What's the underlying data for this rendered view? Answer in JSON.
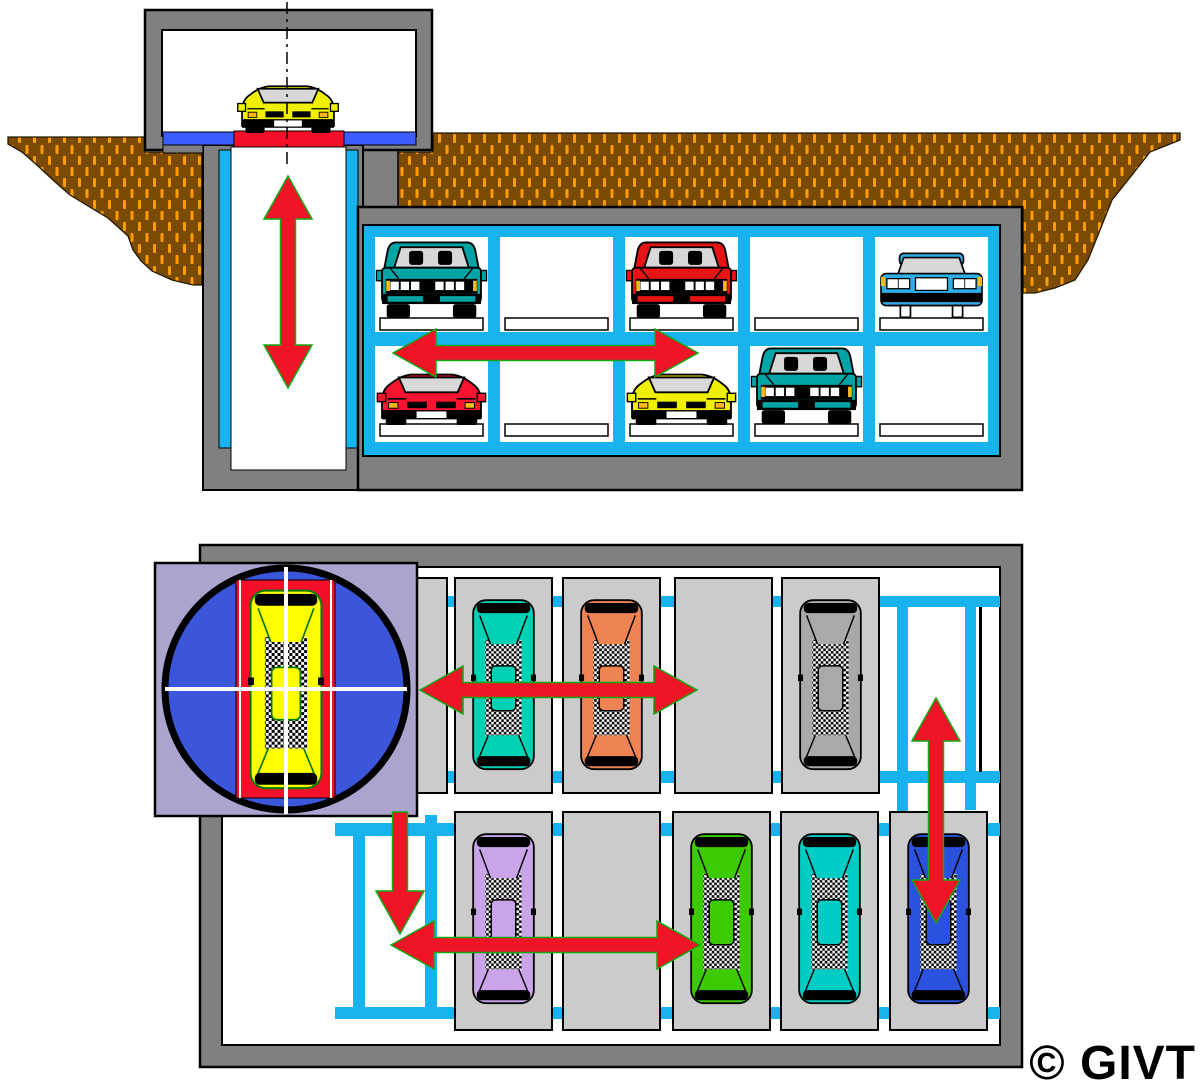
{
  "copyright": {
    "text": "© GIVT"
  },
  "palette": {
    "page_bg": "#FFFFFF",
    "wall_gray": "#808080",
    "stall_gray": "#CBCBCB",
    "rail_cyan": "#18B2EF",
    "arrow_red": "#EF1527",
    "arrow_tip_green": "#12A812",
    "earth_brown": "#7B4B04",
    "earth_hatch_orange": "#FF9C00",
    "floor_blue": "#3D5CFF",
    "platform_red": "#F50F28",
    "turntable_blue": "#3B55DB",
    "inset_lavender": "#ACA4CF",
    "glass_gray": "#D8D8D8",
    "pallet_white": "#FFFFFF"
  },
  "cross_section": {
    "name": "underground-garage-cross-section",
    "earth_polygons": {
      "surface_left": [
        [
          8,
          137
        ],
        [
          145,
          137
        ],
        [
          145,
          152
        ],
        [
          202,
          152
        ],
        [
          202,
          285
        ],
        [
          193,
          285
        ],
        [
          172,
          280
        ],
        [
          152,
          271
        ],
        [
          141,
          261
        ],
        [
          133,
          250
        ],
        [
          128,
          236
        ],
        [
          118,
          227
        ],
        [
          108,
          218
        ],
        [
          88,
          206
        ],
        [
          70,
          195
        ],
        [
          54,
          181
        ],
        [
          38,
          166
        ],
        [
          22,
          152
        ],
        [
          8,
          144
        ]
      ],
      "surface_right": [
        [
          396,
          207
        ],
        [
          396,
          152
        ],
        [
          433,
          152
        ],
        [
          433,
          133
        ],
        [
          1180,
          133
        ],
        [
          1180,
          140
        ],
        [
          1150,
          152
        ],
        [
          1132,
          175
        ],
        [
          1112,
          200
        ],
        [
          1100,
          230
        ],
        [
          1088,
          260
        ],
        [
          1075,
          280
        ],
        [
          1055,
          288
        ],
        [
          1035,
          293
        ],
        [
          1023,
          293
        ],
        [
          1023,
          207
        ]
      ]
    },
    "structures": [
      {
        "name": "shaft-top-connector",
        "x": 357,
        "y": 147,
        "w": 41,
        "h": 78,
        "fill": "wall_gray",
        "stroke": "#000",
        "sw": 1.5
      },
      {
        "name": "entrance-housing",
        "x": 145,
        "y": 10,
        "w": 287,
        "h": 140,
        "fill": "wall_gray",
        "stroke": "#000",
        "sw": 2.5
      },
      {
        "name": "entrance-interior",
        "x": 162,
        "y": 30,
        "w": 254,
        "h": 106,
        "fill": "#FFFFFF",
        "stroke": "#000",
        "sw": 2
      },
      {
        "name": "elevator-shaft-wall",
        "x": 203,
        "y": 145,
        "w": 160,
        "h": 345,
        "fill": "wall_gray",
        "stroke": "#000",
        "sw": 2
      },
      {
        "name": "elevator-shaft",
        "x": 231,
        "y": 147,
        "w": 115,
        "h": 323,
        "fill": "#FFFFFF",
        "stroke": "#000",
        "sw": 1
      },
      {
        "name": "shaft-rail-left",
        "x": 219,
        "y": 150,
        "w": 12,
        "h": 298,
        "fill": "rail_cyan",
        "stroke": "#000",
        "sw": 1
      },
      {
        "name": "shaft-rail-right",
        "x": 346,
        "y": 150,
        "w": 12,
        "h": 298,
        "fill": "rail_cyan",
        "stroke": "#000",
        "sw": 1
      },
      {
        "name": "garage-shell",
        "x": 358,
        "y": 207,
        "w": 664,
        "h": 283,
        "fill": "wall_gray",
        "stroke": "#000",
        "sw": 2.5
      },
      {
        "name": "garage-rack-frame",
        "x": 363,
        "y": 225,
        "w": 637,
        "h": 231,
        "fill": "rail_cyan",
        "stroke": "#000",
        "sw": 2
      },
      {
        "name": "entrance-step-left",
        "x": 163,
        "y": 144,
        "w": 40,
        "h": 9,
        "fill": "wall_gray",
        "stroke": "#000",
        "sw": 1
      },
      {
        "name": "entrance-floor-left",
        "x": 163,
        "y": 132,
        "w": 71,
        "h": 13,
        "fill": "floor_blue",
        "stroke": "#000",
        "sw": 1
      },
      {
        "name": "entrance-floor-right",
        "x": 344,
        "y": 132,
        "w": 72,
        "h": 13,
        "fill": "floor_blue",
        "stroke": "#000",
        "sw": 1
      },
      {
        "name": "elevator-platform",
        "x": 234,
        "y": 131,
        "w": 110,
        "h": 16,
        "fill": "platform_red",
        "stroke": "#000",
        "sw": 1
      }
    ],
    "rack": {
      "cols_x": [
        375,
        500,
        625,
        750,
        875
      ],
      "bay_w": 113,
      "rows": [
        {
          "y": 237,
          "h": 95,
          "pallet_y": 318
        },
        {
          "y": 346,
          "h": 96,
          "pallet_y": 424
        }
      ]
    },
    "center_line": {
      "x": 287,
      "y1": 2,
      "y2": 164
    },
    "cars": [
      {
        "name": "car-yellow-sports-entrance",
        "type": "sports_front",
        "color": "#EFEF00",
        "cx": 288,
        "bottom": 133,
        "w": 104
      },
      {
        "name": "car-teal-sedan-upper-1",
        "type": "sedan_front",
        "color": "#00A4A4",
        "bay": 0,
        "row": 0
      },
      {
        "name": "car-red-sedan-upper-3",
        "type": "sedan_front",
        "color": "#E61414",
        "bay": 2,
        "row": 0
      },
      {
        "name": "car-blue-wide-upper-5",
        "type": "wide_front",
        "color": "#2FADE8",
        "bay": 4,
        "row": 0
      },
      {
        "name": "car-red-sports-lower-1",
        "type": "sports_front",
        "color": "#FA1430",
        "bay": 0,
        "row": 1
      },
      {
        "name": "car-yellow-sports-lower-3",
        "type": "sports_front",
        "color": "#EFEF00",
        "bay": 2,
        "row": 1
      },
      {
        "name": "car-teal-sedan-lower-4",
        "type": "sedan_front",
        "color": "#00A4A4",
        "bay": 3,
        "row": 1
      }
    ],
    "arrows": [
      {
        "name": "elevator-vertical-arrow",
        "dir": "v",
        "x": 288,
        "y1": 176,
        "y2": 388,
        "heads": "both"
      },
      {
        "name": "shuttle-horizontal-arrow",
        "dir": "h",
        "y": 353,
        "x1": 393,
        "x2": 698,
        "heads": "both"
      }
    ]
  },
  "plan_view": {
    "name": "garage-plan-view",
    "structures": [
      {
        "name": "plan-outer-wall",
        "x": 200,
        "y": 545,
        "w": 822,
        "h": 522,
        "fill": "wall_gray",
        "stroke": "#000",
        "sw": 2.5
      },
      {
        "name": "plan-floor",
        "x": 222,
        "y": 567,
        "w": 778,
        "h": 478,
        "fill": "#FFFFFF",
        "stroke": "#000",
        "sw": 2
      }
    ],
    "guide_lines": [
      {
        "name": "guide-h-top",
        "x": 440,
        "y": 596,
        "w": 560,
        "h": 11
      },
      {
        "name": "guide-h-mid-upper",
        "x": 440,
        "y": 771,
        "w": 560,
        "h": 12
      },
      {
        "name": "guide-h-mid-lower",
        "x": 335,
        "y": 823,
        "w": 665,
        "h": 13
      },
      {
        "name": "guide-h-bottom",
        "x": 335,
        "y": 1007,
        "w": 665,
        "h": 12
      },
      {
        "name": "guide-v-lift-left",
        "x": 897,
        "y": 596,
        "w": 11,
        "h": 422
      },
      {
        "name": "guide-v-lift-right",
        "x": 965,
        "y": 596,
        "w": 11,
        "h": 214
      },
      {
        "name": "guide-v-shuttle-left",
        "x": 353,
        "y": 823,
        "w": 12,
        "h": 196
      },
      {
        "name": "guide-v-shuttle-right",
        "x": 425,
        "y": 815,
        "w": 12,
        "h": 204
      }
    ],
    "rail_marks": [
      {
        "name": "lift-rail-mark",
        "x": 979,
        "y": 607,
        "w": 3,
        "h": 165,
        "fill": "#000"
      }
    ],
    "stall_w": 97,
    "stall_h": [
      215,
      218
    ],
    "stalls": [
      {
        "name": "stall-u0",
        "x": 350,
        "y": 578,
        "row": 0
      },
      {
        "name": "stall-u1",
        "x": 455,
        "y": 578,
        "row": 0
      },
      {
        "name": "stall-u2",
        "x": 563,
        "y": 578,
        "row": 0
      },
      {
        "name": "stall-u3-empty",
        "x": 675,
        "y": 578,
        "row": 0
      },
      {
        "name": "stall-u4",
        "x": 782,
        "y": 578,
        "row": 0
      },
      {
        "name": "stall-l1",
        "x": 455,
        "y": 812,
        "row": 1
      },
      {
        "name": "stall-l2-empty",
        "x": 563,
        "y": 812,
        "row": 1
      },
      {
        "name": "stall-l3",
        "x": 673,
        "y": 812,
        "row": 1
      },
      {
        "name": "stall-l4",
        "x": 781,
        "y": 812,
        "row": 1
      },
      {
        "name": "stall-l5",
        "x": 890,
        "y": 812,
        "row": 1
      }
    ],
    "cars": [
      {
        "name": "plan-car-teal",
        "stall": 1,
        "color": "#00D0B4"
      },
      {
        "name": "plan-car-orange",
        "stall": 2,
        "color": "#EF8452"
      },
      {
        "name": "plan-car-gray",
        "stall": 4,
        "color": "#A9A9A9"
      },
      {
        "name": "plan-car-purple",
        "stall": 5,
        "color": "#C9A4E9"
      },
      {
        "name": "plan-car-green",
        "stall": 7,
        "color": "#3CCB00"
      },
      {
        "name": "plan-car-teal-2",
        "stall": 8,
        "color": "#00CCC6"
      },
      {
        "name": "plan-car-blue",
        "stall": 9,
        "color": "#2B52DE"
      }
    ],
    "turntable": {
      "square": {
        "x": 155,
        "y": 563,
        "w": 262,
        "h": 253
      },
      "circle": {
        "cx": 286,
        "cy": 689,
        "r": 121
      },
      "pallet": {
        "x": 236,
        "y": 580,
        "w": 99,
        "h": 218
      },
      "car": {
        "name": "plan-car-yellow-turntable",
        "color": "#FFFF00",
        "outline": "#0A7A0A",
        "x": 248,
        "y": 588,
        "w": 76
      }
    },
    "arrows": [
      {
        "name": "plan-shuttle-arrow-upper",
        "dir": "h",
        "y": 690,
        "x1": 420,
        "x2": 697,
        "heads": "both"
      },
      {
        "name": "plan-lift-arrow",
        "dir": "v",
        "x": 936,
        "y1": 698,
        "y2": 923,
        "heads": "both"
      },
      {
        "name": "plan-turntable-exit-arrow",
        "dir": "v",
        "x": 400,
        "y1": 812,
        "y2": 934,
        "heads": "end"
      },
      {
        "name": "plan-shuttle-arrow-lower",
        "dir": "h",
        "y": 945,
        "x1": 391,
        "x2": 700,
        "heads": "both"
      }
    ]
  }
}
